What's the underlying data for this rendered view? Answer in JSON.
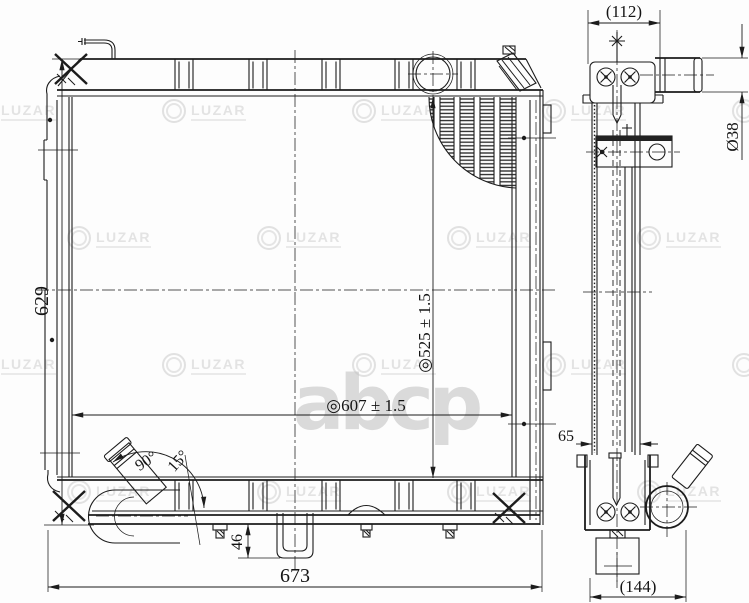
{
  "dimensions": {
    "overall_height": "629",
    "overall_width": "673",
    "mount_width": "◎607 ± 1.5",
    "core_height": "◎525 ± 1.5",
    "drain_bracket_height": "46",
    "outlet_angle": "90°",
    "outlet_tilt_angle": "15°",
    "top_depth": "(112)",
    "inlet_pipe_diameter": "Ø38",
    "core_depth": "65",
    "bottom_depth": "(144)"
  },
  "watermarks": {
    "brand": "LUZAR",
    "portal": "abcp",
    "brand_color": "#d2d2d2",
    "portal_color": "#c5c5c5"
  }
}
